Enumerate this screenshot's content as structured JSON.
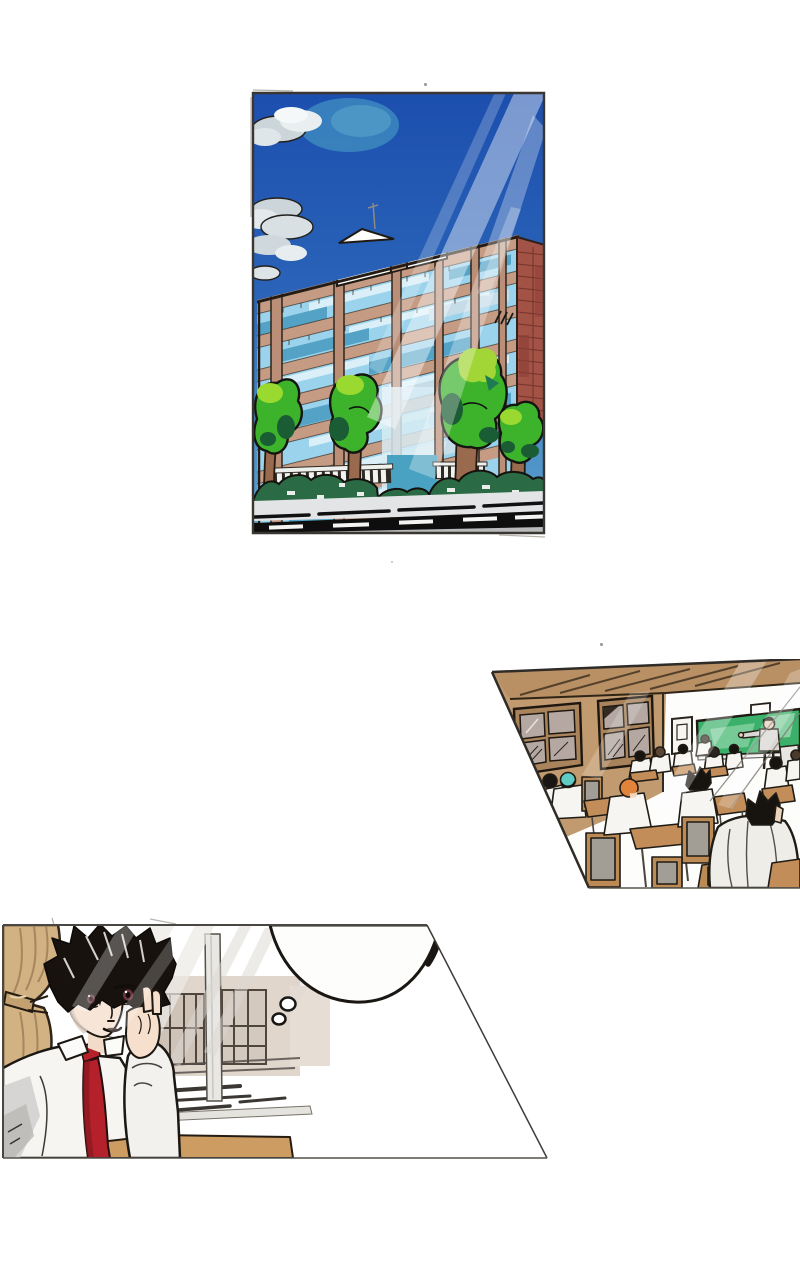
{
  "page": {
    "kind": "manga page",
    "background": "#ffffff",
    "description": "A wordless three-panel manga page: a school building exterior under a sunny blue sky, a classroom full of students seen from the back corner, and a close-up of a boy in a white shirt and red necktie daydreaming by the window with an empty thought bubble."
  },
  "panels": [
    {
      "id": "school-exterior",
      "shape": "hand-drawn rectangle",
      "label": "Exterior of a multi-story school building with striped blue windows and a brick side wall, green trees and hedges in front, a white fence, a road with dark asphalt in the foreground, deep blue sky with gray clouds and diagonal sunbeams from the top right.",
      "colors": {
        "sky_top": "#1c4fae",
        "sky_bottom": "#5ba4cf",
        "cloud": "#ccd5d9",
        "facade_tan": "#c59b83",
        "window_blue": "#9cd3ec",
        "window_teal": "#54a3c6",
        "brick_red": "#a35246",
        "tree_green": "#3db32c",
        "tree_highlight": "#9ad92f",
        "bush_dark_green": "#2a6b46",
        "trunk_brown": "#996a4e",
        "asphalt": "#0e0e0e",
        "sidewalk": "#e3e4e5"
      }
    },
    {
      "id": "classroom",
      "shape": "slanted quadrilateral, cut off at right page edge",
      "label": "A classroom viewed from the back-left corner: tan walls and ceiling beams, two windows, a green chalkboard with a teacher pointing beside it, and many students in white shirts seated at wooden desks with gray-backed chairs; one student wears a teal cap and one has orange hair.",
      "colors": {
        "wall_tan": "#c29a6f",
        "ceiling_tan": "#b98f64",
        "window_pane": "#b5a8a2",
        "chalkboard_green": "#3bb06a",
        "desk_wood": "#c28d58",
        "chair_gray": "#a29e96",
        "chair_frame": "#bb8a55",
        "shirt_white": "#f6f5f1",
        "teal_cap": "#5fccc4",
        "orange_hair": "#e2833b"
      }
    },
    {
      "id": "daydreaming-student",
      "shape": "trapezoid, wider at bottom right",
      "label": "Close-up of a black-haired boy in a white shirt and red necktie resting his cheek on his hand at a wooden desk beside a window with a tan curtain; an empty thought bubble with two trailing circles floats to his right.",
      "colors": {
        "curtain_tan": "#d2b183",
        "hair_black": "#17120e",
        "skin": "#f7e6d8",
        "iris_maroon": "#6e3644",
        "necktie_red": "#b5212b",
        "shirt_white": "#f6f5f2",
        "desk_wood": "#cd9c63",
        "outside_building": "#ddd2c7"
      },
      "thought_bubble": {
        "present": true,
        "text": ""
      }
    }
  ]
}
